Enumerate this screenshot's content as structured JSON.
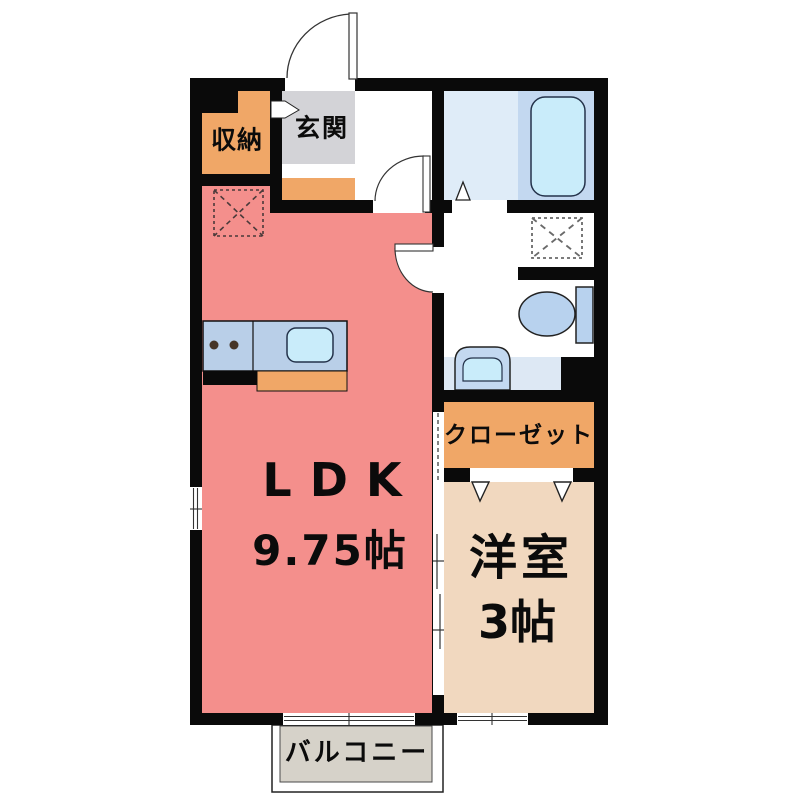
{
  "plan": {
    "rooms": {
      "storage": {
        "label": "収納"
      },
      "entrance": {
        "label": "玄関"
      },
      "ldk": {
        "label": "LDK",
        "size": "9.75帖"
      },
      "closet": {
        "label": "クローゼット"
      },
      "western_room": {
        "label": "洋室",
        "size": "3帖"
      },
      "balcony": {
        "label": "バルコニー"
      }
    },
    "fixtures": {
      "bathtub": "bathtub",
      "kitchen_counter": "kitchen counter with sink and two burners",
      "toilet": "toilet with tank",
      "washbasin": "washbasin unit",
      "washing_machine_space": "washing-machine space (dashed square)",
      "ldk_dashed_space": "equipment space (dashed square)"
    },
    "colors": {
      "wall": "#0a0a0a",
      "ldk_pink": "#f48f8c",
      "orange": "#f0a767",
      "entrance_gray": "#d3d3d7",
      "western_tan": "#f1d8bf",
      "bath_light_blue": "#dfecf8",
      "bath_tub_area_blue": "#c3d8f0",
      "fixture_blue": "#b8d2ee",
      "water_cyan": "#c9ecfa",
      "counter_blue": "#b9cfe8",
      "washroom_counter_blue": "#dde8f4",
      "balcony_gray": "#d6d2c9"
    }
  }
}
